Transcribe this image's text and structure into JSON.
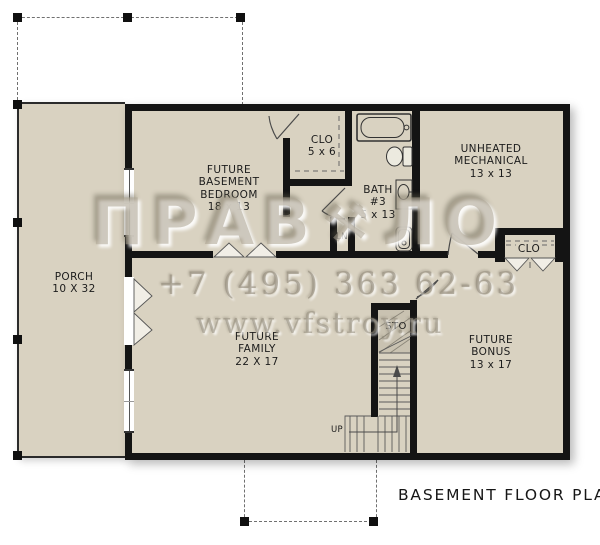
{
  "caption": "BASEMENT FLOOR PLAN",
  "rooms": {
    "porch": {
      "lines": [
        "PORCH",
        "10 X 32"
      ]
    },
    "bedroom": {
      "lines": [
        "FUTURE",
        "BASEMENT",
        "BEDROOM",
        "18 x 13"
      ]
    },
    "closet": {
      "lines": [
        "CLO",
        "5 x 6"
      ]
    },
    "bath": {
      "lines": [
        "BATH",
        "#3",
        "5 x 13"
      ]
    },
    "mechanical": {
      "lines": [
        "UNHEATED",
        "MECHANICAL",
        "13 x 13"
      ]
    },
    "closet2": {
      "lines": [
        "CLO"
      ]
    },
    "family": {
      "lines": [
        "FUTURE",
        "FAMILY",
        "22 X 17"
      ]
    },
    "bonus": {
      "lines": [
        "FUTURE",
        "BONUS",
        "13 x 17"
      ]
    },
    "storage": {
      "lines": [
        "STO"
      ]
    },
    "linen": {
      "lines": [
        "LN"
      ]
    },
    "stairs": {
      "up_label": "UP"
    }
  },
  "watermark": {
    "logo_left": "ПРАВ",
    "logo_icon": "⚒",
    "logo_right": "ЛО",
    "phone": "+7 (495) 363 62-63",
    "website": "www.vfstroy.ru"
  },
  "colors": {
    "floor": "#d9d2c1",
    "wall": "#141414",
    "watermark": "#948d7c"
  }
}
